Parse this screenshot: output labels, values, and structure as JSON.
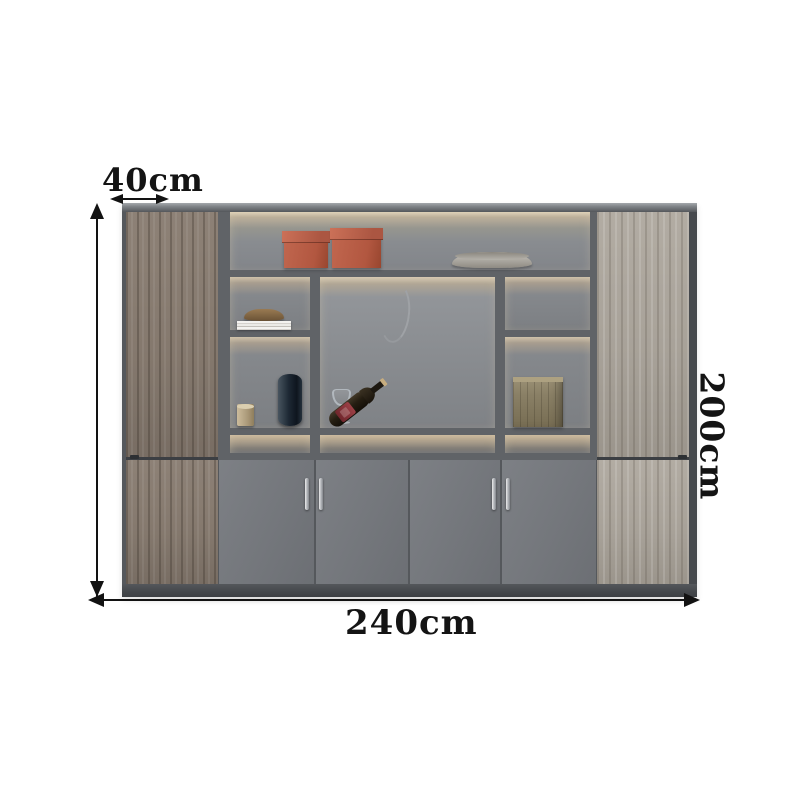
{
  "product_diagram": {
    "depth_label": "40cm",
    "height_label": "200cm",
    "width_label": "240cm"
  },
  "palette": {
    "background": "#ffffff",
    "frame": "#55585c",
    "left_wood": "#86796e",
    "right_wood": "#a8a299",
    "back_panel": "#83868a",
    "led_glow": "#d8cbb4",
    "lower_doors": "#74777c",
    "storage_box": "#b85c45",
    "annotation": "#141414"
  },
  "decor": {
    "top_shelf": [
      "terracotta-storage-box",
      "terracotta-storage-box",
      "decorative-platter"
    ],
    "left_shelves": [
      "bronze-bowl-on-magazines",
      "candle",
      "dark-blue-vase"
    ],
    "center_shelf": [
      "wine-glass",
      "wine-bottle-on-stand"
    ],
    "right_shelves": [
      "wooden-crate"
    ]
  }
}
